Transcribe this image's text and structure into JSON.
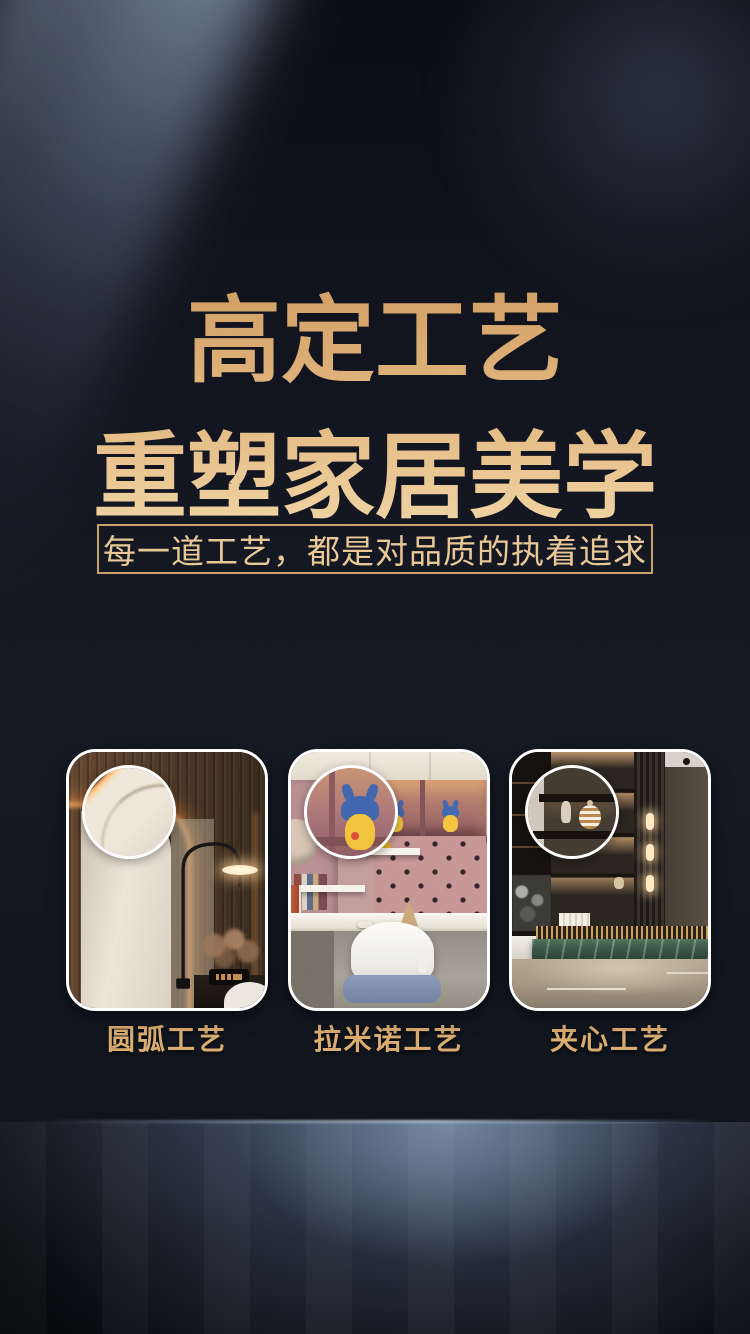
{
  "page": {
    "type": "promo-poster",
    "title": {
      "line1": "高定工艺",
      "line2": "重塑家居美学"
    },
    "tagline": "每一道工艺，都是对品质的执着追求",
    "crafts": [
      {
        "label": "圆弧工艺",
        "photo": "bedroom-wardrobe-rounded-corner",
        "overlay_icon": "detail-zoom-circle"
      },
      {
        "label": "拉米诺工艺",
        "photo": "kids-study-room-lamello-joint",
        "overlay_icon": "detail-zoom-circle"
      },
      {
        "label": "夹心工艺",
        "photo": "luxury-lounge-display-cabinet",
        "overlay_icon": "detail-zoom-circle"
      }
    ],
    "colors": {
      "gold_dark": "#cf9a60",
      "gold_mid": "#e3b87f",
      "gold_light": "#f2d8a8",
      "tagline_border": "#c9a065",
      "tagline_text": "#e9c795",
      "label_text": "#d9ab6e",
      "card_border": "#ffffff",
      "beam_blue": "#a8bcd7",
      "background": "#10141d"
    }
  }
}
